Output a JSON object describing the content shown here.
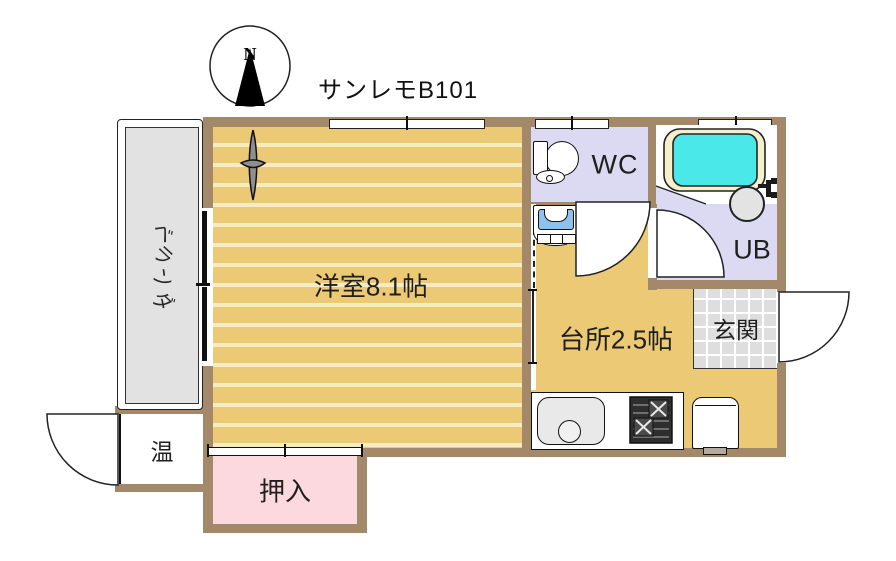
{
  "title": "サンレモB101",
  "compass": {
    "north_label": "N"
  },
  "rooms": {
    "western_room": {
      "label": "洋室8.1帖"
    },
    "kitchen": {
      "label": "台所2.5帖"
    },
    "wc": {
      "label": "WC"
    },
    "unit_bath": {
      "label": "UB"
    },
    "entrance": {
      "label": "玄関"
    },
    "closet": {
      "label": "押入"
    },
    "water_heater": {
      "label": "温"
    },
    "veranda": {
      "label": "ベランダ",
      "chars": [
        "ベ",
        "ラ",
        "ン",
        "ダ"
      ]
    }
  },
  "fixtures": [
    "toilet",
    "bathtub",
    "washbasin",
    "washing-machine-pan",
    "kitchen-sink",
    "gas-stove",
    "refrigerator"
  ],
  "colors": {
    "wall": "#a3886a",
    "wood_floor": "#ebc975",
    "floor_stripe": "#f6ecc2",
    "wet_area_floor": "#dbdaf2",
    "closet_pink": "#fbd9de",
    "entrance_tile": "#dedede",
    "veranda_gray": "#e2e2e2",
    "bath_water": "#4ae8e8",
    "tub_rim": "#f6efcc",
    "washer_blue": "#8ec1ec"
  }
}
